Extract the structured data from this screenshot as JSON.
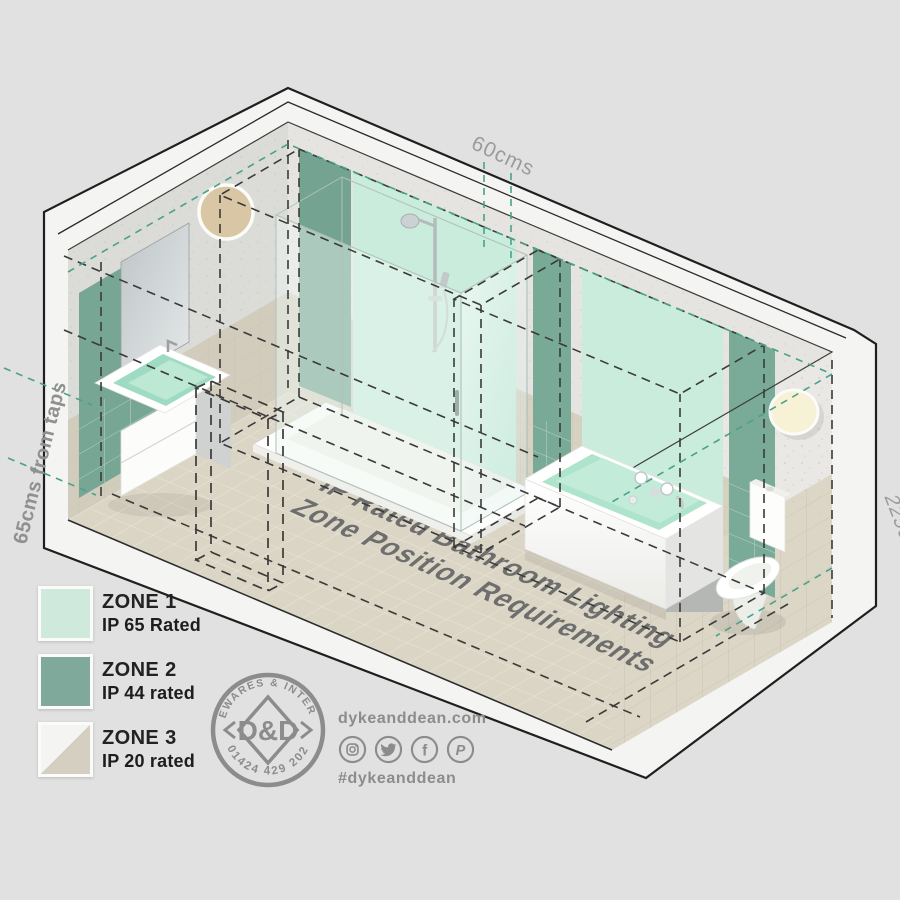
{
  "title_overlay": {
    "line1": "IP Rated Bathroom Lighting",
    "line2": "Zone Position Requirements"
  },
  "dimensions": {
    "shower_zone_width": "60cms",
    "distance_from_taps": "65cms from taps",
    "zone_height": "225cms"
  },
  "legend": {
    "items": [
      {
        "zone": "ZONE 1",
        "rating": "IP 65 Rated",
        "swatch_color": "#cfeadd"
      },
      {
        "zone": "ZONE 2",
        "rating": "IP 44 rated",
        "swatch_color": "#7fa99a"
      },
      {
        "zone": "ZONE 3",
        "rating": "IP 20 rated",
        "swatch_color": "#f4f4f2 / #d5cfc1"
      }
    ]
  },
  "branding": {
    "stamp_text_top": "HOMEWARES & INTERIORS",
    "stamp_text_bottom": "01424 429 202",
    "stamp_monogram": "D&D",
    "website": "dykeanddean.com",
    "hashtag": "#dykeanddean",
    "social_icons": [
      "instagram",
      "twitter",
      "facebook",
      "pinterest"
    ]
  },
  "palette": {
    "zone1_mint": "#cfeadd",
    "zone2_green": "#7fa99a",
    "zone3_beige": "#d5cfc1",
    "teal_dash": "#4aa18c",
    "label_gray": "#8c8c8c",
    "background": "#e1e1e1"
  }
}
